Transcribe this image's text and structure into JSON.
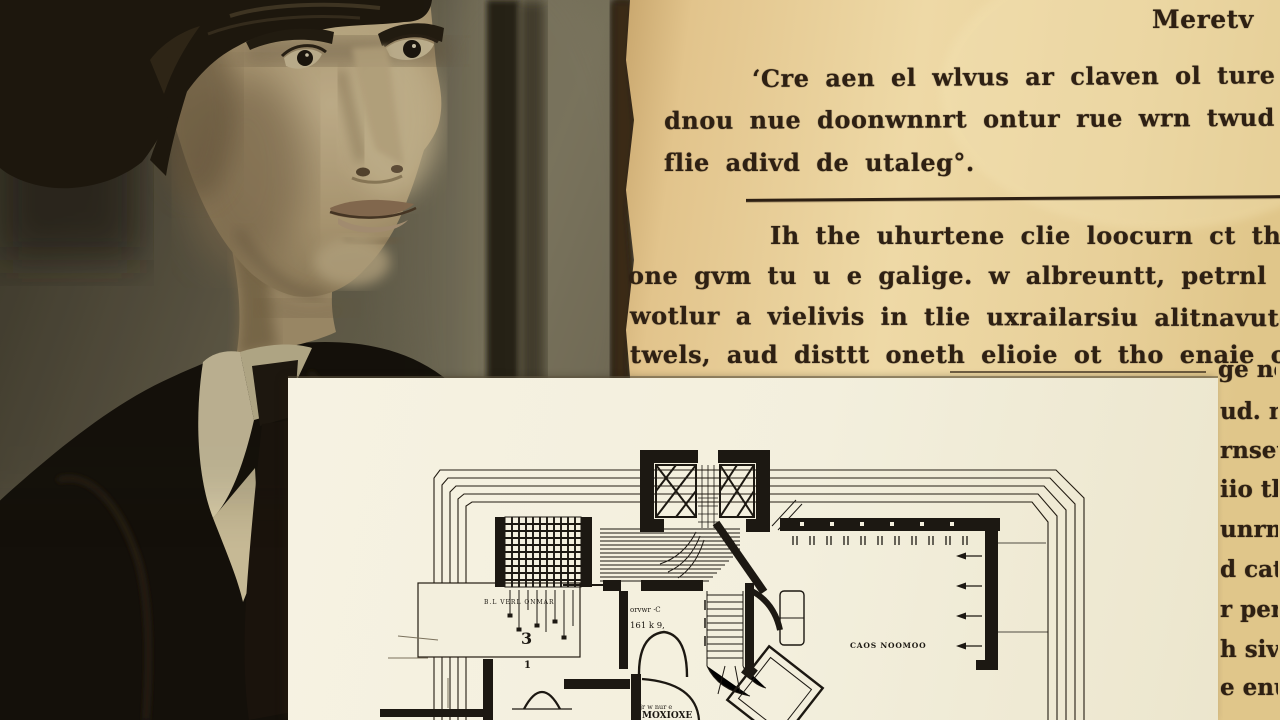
{
  "page": {
    "header": "Meretv",
    "para1": [
      "‘Cre aen el wlvus ar claven ol ture ar a",
      "dnou nue doonwnnrt ontur rue wrn twud doclii a",
      "flie adivd de utaleg°."
    ],
    "para2": [
      "Ih the uhurtene clie loocurn ct the ot atti",
      "one gvm tu u e galige. w albreuntt, petrnl Xeou",
      "wotlur a vielivis in tlie uxrailarsiu alitnavute",
      "twels, aud disttt oneth elioie ot tho enaie oaind"
    ],
    "edge_fragments": [
      "ge nol",
      "ud. n",
      "rnseu",
      "iio th",
      "unrn",
      "d cat",
      "r per-",
      "h siv",
      "e enu"
    ]
  },
  "floor_plan": {
    "labels": {
      "large_room": "CAOS NOOMOO",
      "room_a_1": "orvwr ·C",
      "room_a_2": "161 k 9,",
      "room_b_1": "jr w nur e",
      "room_b_2": "MOXIOXE",
      "dim_text": "B.L VERL ONMAR",
      "dim_digit": "3",
      "dim_digit_2": "1"
    }
  },
  "colors": {
    "page_tan": "#e8cf9a",
    "card_cream": "#f3efdd",
    "ink": "#2a1f14",
    "photo_bg_olive": "#6a6350",
    "suit_black": "#14100a",
    "skin_sepia": "#bfa87e"
  }
}
